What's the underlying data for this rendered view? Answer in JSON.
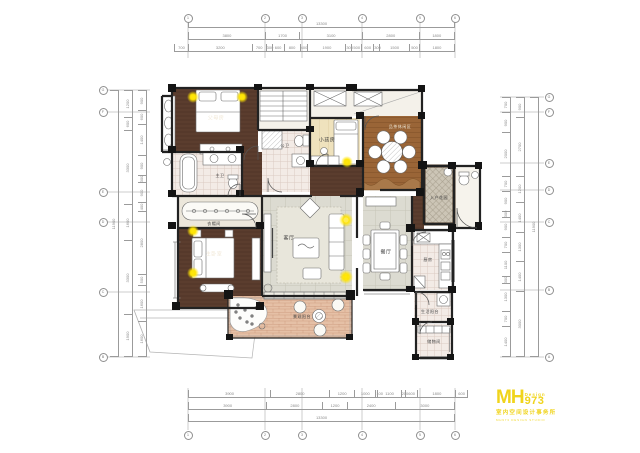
{
  "rooms": {
    "parents": "父母房",
    "kids": "小孩房",
    "public_bath": "公卫",
    "master_bath": "主卫",
    "cloakroom": "衣帽间",
    "master": "主卧室",
    "living": "客厅",
    "dining": "餐厅",
    "tea": "品茶休闲区",
    "entry": "入户花园",
    "kitchen": "厨房",
    "service_balcony": "生活阳台",
    "storage": "储物间",
    "view_balcony": "景观阳台"
  },
  "dims": {
    "top": {
      "total": [
        "13300"
      ],
      "row2": [
        "3800",
        "1700",
        "3100",
        "2800",
        "1800"
      ],
      "row3": [
        "700",
        "3200",
        "700",
        "300",
        "600",
        "800",
        "400",
        "1900",
        "300",
        "500",
        "600",
        "300",
        "1500",
        "500",
        "1800"
      ]
    },
    "bottom": {
      "row1": [
        "3900",
        "2800",
        "1200",
        "1000",
        "100",
        "1100",
        "200",
        "600",
        "1800",
        "600"
      ],
      "row2": [
        "3900",
        "2800",
        "1200",
        "2400",
        "3000"
      ],
      "total": [
        "13300"
      ]
    },
    "left": {
      "inner": [
        "900",
        "600",
        "1400",
        "900",
        "300",
        "900",
        "400",
        "2800",
        "500",
        "1600",
        "1600"
      ],
      "outer": [
        "1200",
        "600",
        "3300",
        "1600",
        "3300",
        "1900"
      ],
      "total": [
        "11900"
      ]
    },
    "right": {
      "inner": [
        "700",
        "900",
        "2000",
        "700",
        "900",
        "300",
        "900",
        "700",
        "1100",
        "300",
        "1300",
        "700",
        "1400"
      ],
      "outer": [
        "900",
        "2700",
        "1200",
        "1400",
        "1300",
        "1400",
        "3000"
      ],
      "total": [
        "11900"
      ]
    }
  },
  "grid": {
    "top": [
      "1",
      "2",
      "3",
      "4",
      "5",
      "6"
    ],
    "bottom": [
      "1",
      "2",
      "3",
      "4",
      "5",
      "6"
    ],
    "left": [
      "G",
      "F",
      "E",
      "D",
      "C",
      "B"
    ],
    "right": [
      "G",
      "F",
      "E",
      "D",
      "C",
      "B",
      "A"
    ]
  },
  "logo": {
    "mh": "MH",
    "design": "Design",
    "number": "973",
    "subtitle": "室内空间设计事务所",
    "tagline": "MH973 DESIGN STUDIO",
    "color": "#f0d41c"
  },
  "accent_colors": {
    "light_glow": "#ffe400",
    "dark_wood": "#56392b",
    "mid_wood": "#9a6537",
    "brick": "#e5c0a6"
  }
}
